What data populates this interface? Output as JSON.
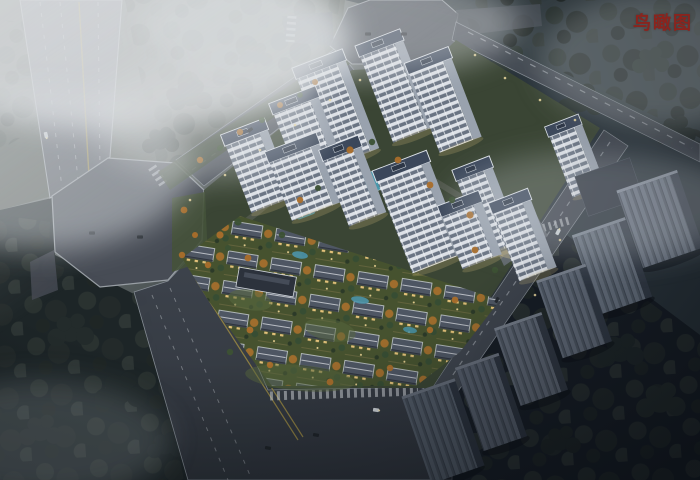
{
  "header": {
    "title": "鸟瞰图",
    "title_color": "#8a241e"
  },
  "scene": {
    "type": "aerial-architectural-rendering",
    "setting": "dusk",
    "features": [
      "octagonal road intersections",
      "multi-lane avenue with yellow center line",
      "white high-rise residential towers with dark hipped roofs",
      "low-rise townhouse villa district",
      "landscaped grounds with autumn trees",
      "amenity pools",
      "entrance gate canopy",
      "dark context apartment slabs",
      "perimeter forest",
      "fog and haze",
      "cars with headlights"
    ],
    "palette": {
      "fog": "#dfe3e6",
      "terrain_light": "#555c55",
      "terrain_dark": "#1d2527",
      "road": "#4a5058",
      "curb": "#9aa0a6",
      "lane_white": "#cfd3d8",
      "lane_yellow": "#a8954a",
      "tower_facade": "#dde1e7",
      "tower_windows": "#6a7483",
      "tower_roof": "#3b475a",
      "villa_roof": "#4e5663",
      "lawn": "#46522f",
      "autumn_tree": "#a9702c",
      "evergreen_tree": "#374d33",
      "pool_water": "#47a0b8",
      "context_building": "#6f7987",
      "warm_light": "#ecd9a0"
    }
  }
}
